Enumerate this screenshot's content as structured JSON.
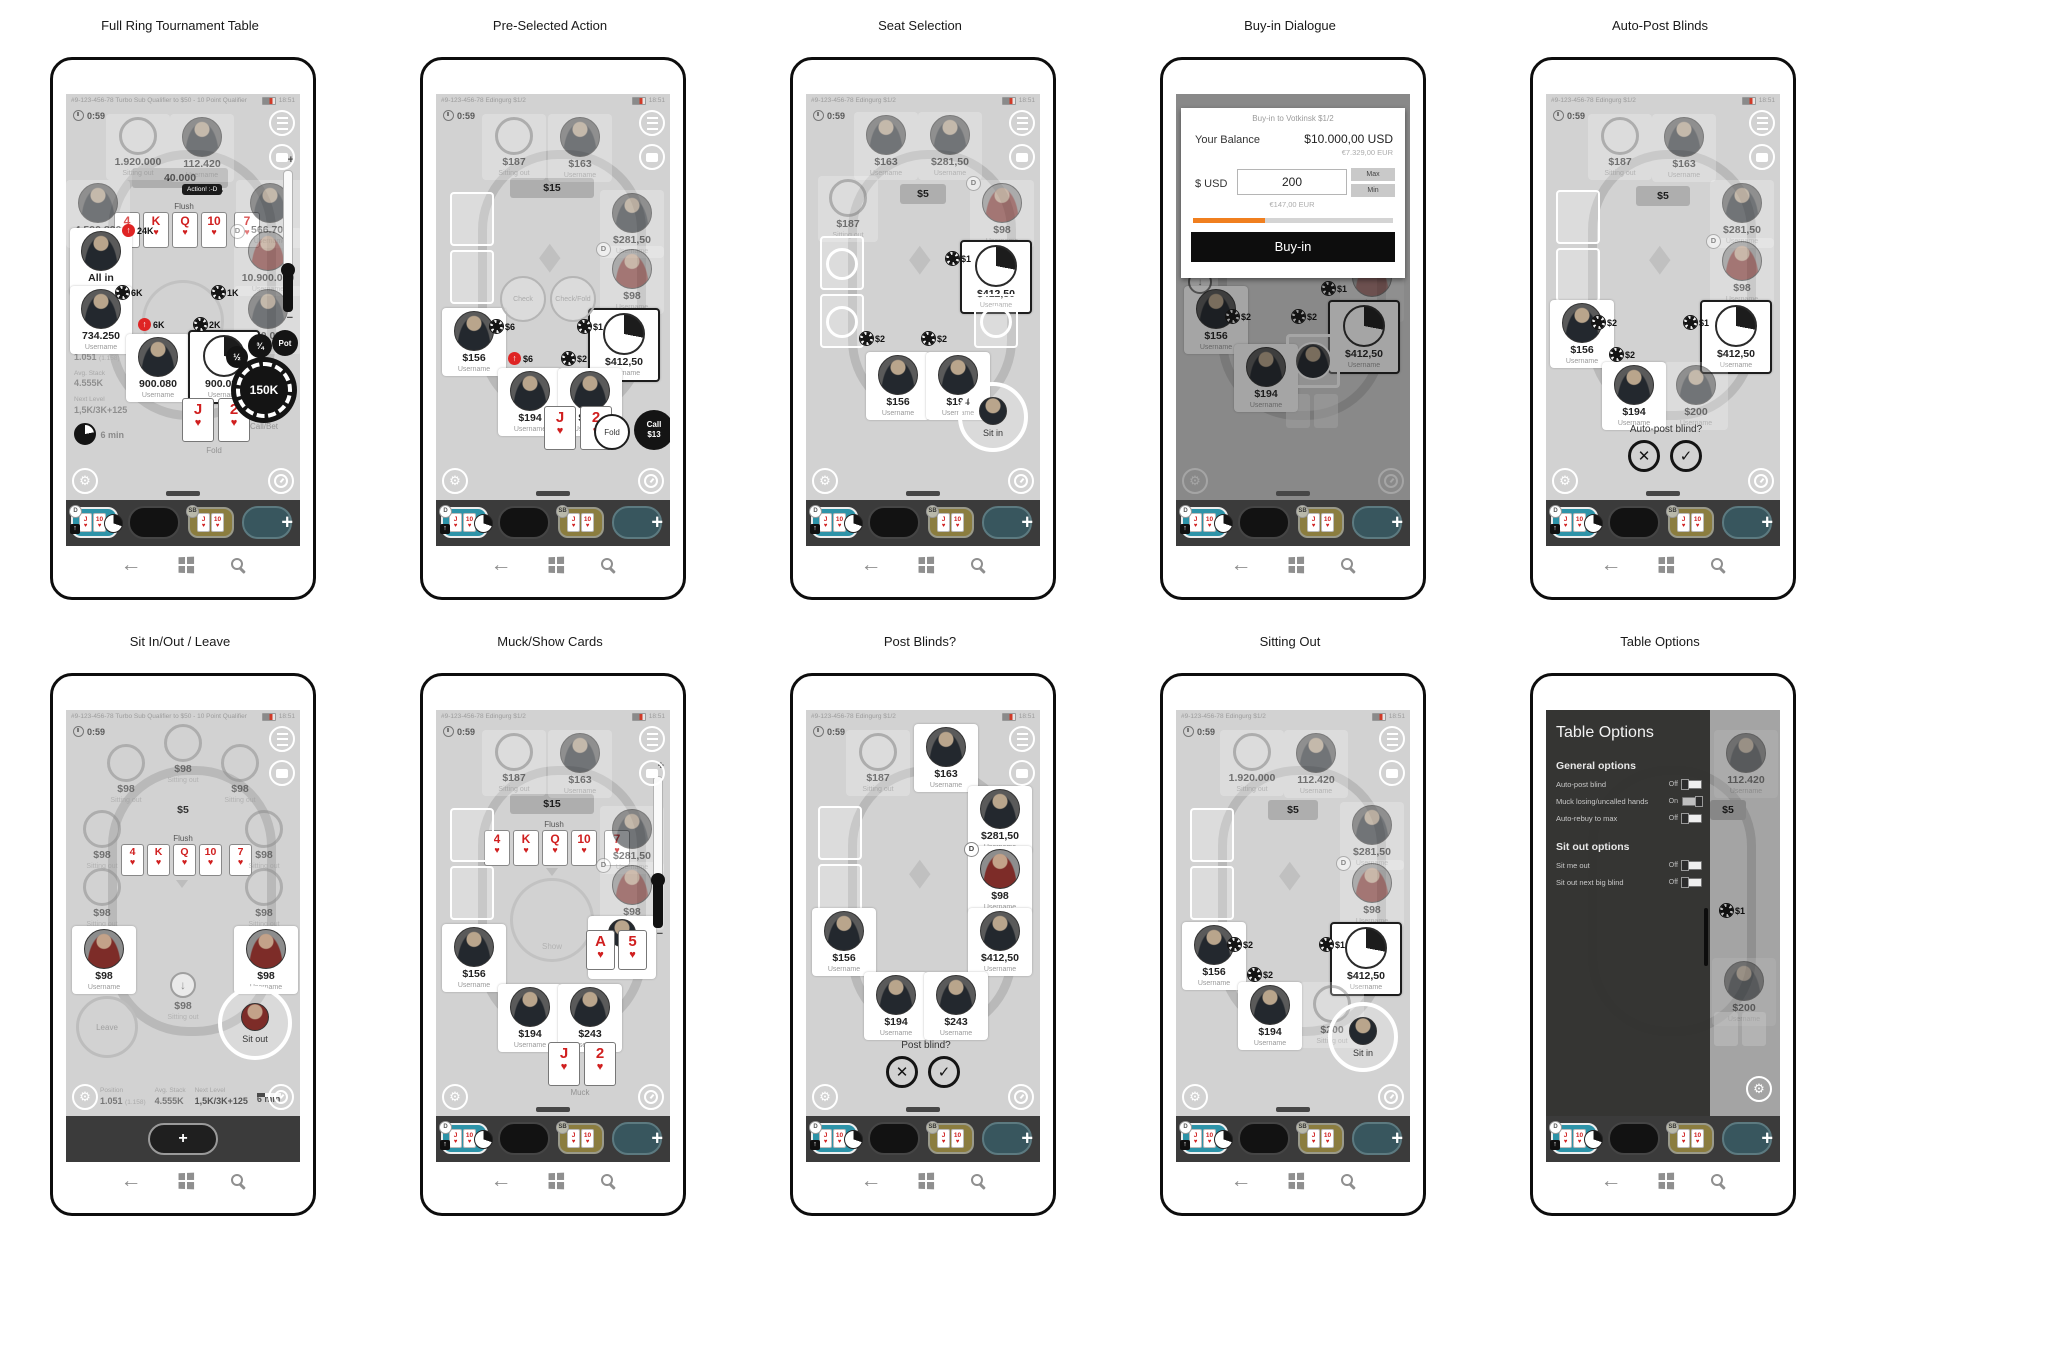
{
  "icons": {
    "up_arrow": "↑",
    "down_arrow": "↓",
    "close": "✕",
    "confirm": "✓",
    "plus": "+",
    "minus": "−",
    "back": "←",
    "heart": "♥",
    "diamond": "◆",
    "gear": "⚙",
    "half": "½",
    "three_quarters": "¾"
  },
  "shared": {
    "status_tourney": "#9-123-456-78  Turbo Sub Qualifier to $50 - 10 Point Qualifier",
    "status_cash": "#9-123-456-78  Edingurg $1/2",
    "clock": "18:51",
    "hand_timer": "0:59",
    "username": "Username",
    "sitting_out": "Sitting out",
    "flush": "Flush",
    "board": [
      "4",
      "K",
      "Q",
      "10",
      "7"
    ],
    "hero_cards": [
      "J",
      "2"
    ],
    "mini_cards": [
      "J",
      "10"
    ],
    "dealer_badge": "D",
    "sb_badge": "SB",
    "check": "Check",
    "check_fold": "Check/Fold",
    "fold": "Fold",
    "show": "Show",
    "muck": "Muck",
    "sit_in": "Sit in",
    "sit_out": "Sit out",
    "leave": "Leave",
    "pot_label": "Pot",
    "info": {
      "position_label": "Position",
      "position": "1.051",
      "position_alt": "(1.158)",
      "avg_label": "Avg. Stack",
      "avg": "4.555K",
      "next_label": "Next Level",
      "next": "1,5K/3K+125",
      "mins": "6 min"
    }
  },
  "phones": [
    {
      "title": "Full Ring Tournament Table",
      "pot": "40.000",
      "chat_bubble": "Action! :-D",
      "seats": {
        "tl": "1.920.000",
        "tr": "112.420",
        "l1": "4.590.800",
        "r1": "566.700",
        "l2": "All in",
        "r2": "10.900.080",
        "l3": "734.250",
        "r3": "900.080",
        "b1": "900.080",
        "hero": "900.080"
      },
      "bets": {
        "raise_a": "24K",
        "left": "6K",
        "right": "1K",
        "raise_b": "6K",
        "mid": "2K"
      },
      "actions": {
        "main": "150K",
        "main_label": "Call/Bet"
      }
    },
    {
      "title": "Pre-Selected Action",
      "pot": "$15",
      "seats": {
        "tl": "$187",
        "tr": "$163",
        "r1": "$281,50",
        "r2": "$98",
        "active": "$412,50",
        "l1": "$156",
        "b1": "$194",
        "b2": "$243"
      },
      "bets": {
        "left": "$6",
        "right": "$1",
        "raise": "$6",
        "mid": "$2"
      },
      "actions": {
        "call": "Call",
        "call_amount": "$13"
      }
    },
    {
      "title": "Seat Selection",
      "pot": "$5",
      "seats": {
        "t1": "$163",
        "t2": "$281,50",
        "l_sit": "$187",
        "r1": "$98",
        "active": "$412,50",
        "b1": "$156",
        "b2": "$194"
      },
      "bets": {
        "b1": "$2",
        "b2": "$2",
        "b3": "$1"
      }
    },
    {
      "title": "Buy-in Dialogue",
      "dialog": {
        "title": "Buy-in to Votkinsk $1/2",
        "balance_label": "Your Balance",
        "balance_usd": "$10.000,00 USD",
        "balance_eur": "€7.329,00 EUR",
        "currency": "$ USD",
        "amount": "200",
        "max": "Max",
        "min": "Min",
        "amount_eur": "€147,00 EUR",
        "submit": "Buy-in"
      },
      "seats": {
        "r1": "$98",
        "active": "$412,50",
        "l1": "$156",
        "b1": "$194"
      },
      "bets": {
        "b1": "$2",
        "b2": "$2",
        "b3": "$1"
      }
    },
    {
      "title": "Auto-Post Blinds",
      "pot": "$5",
      "prompt": "Auto-post blind?",
      "seats": {
        "tl": "$187",
        "tr": "$163",
        "r1": "$281,50",
        "r2": "$98",
        "active": "$412,50",
        "l1": "$156",
        "b1": "$194",
        "b2": "$200"
      },
      "bets": {
        "b1": "$2",
        "b2": "$2",
        "b3": "$1"
      }
    },
    {
      "title": "Sit In/Out / Leave",
      "pot": "$5",
      "sit_stack": "$98",
      "player_stack": "$98"
    },
    {
      "title": "Muck/Show Cards",
      "pot": "$15",
      "shown_cards": [
        "A",
        "5"
      ],
      "seats": {
        "tl": "$187",
        "tr": "$163",
        "r1": "$281,50",
        "r2": "$98",
        "l1": "$156",
        "b1": "$194",
        "b2": "$243"
      }
    },
    {
      "title": "Post Blinds?",
      "prompt": "Post blind?",
      "seats": {
        "tl": "$187",
        "tr": "$163",
        "r1": "$281,50",
        "r2": "$98",
        "r3": "$412,50",
        "l1": "$156",
        "b1": "$194",
        "b2": "$243"
      }
    },
    {
      "title": "Sitting Out",
      "pot": "$5",
      "seats": {
        "tl": "1.920.000",
        "tr": "112.420",
        "r1": "$281,50",
        "r2": "$98",
        "active": "$412,50",
        "l1": "$156",
        "b1": "$194",
        "bc": "$200"
      },
      "bets": {
        "b1": "$2",
        "b2": "$2",
        "b3": "$1"
      }
    },
    {
      "title": "Table Options",
      "panel": {
        "title": "Table Options",
        "general_header": "General options",
        "general": [
          {
            "label": "Auto-post blind",
            "state": "Off"
          },
          {
            "label": "Muck losing/uncalled hands",
            "state": "On"
          },
          {
            "label": "Auto-rebuy to max",
            "state": "Off"
          }
        ],
        "sitout_header": "Sit out options",
        "sitout": [
          {
            "label": "Sit me out",
            "state": "Off"
          },
          {
            "label": "Sit out next big blind",
            "state": "Off"
          }
        ]
      },
      "bg": {
        "tr": "112.420",
        "pot": "$5",
        "bet": "$1",
        "b2": "$200"
      }
    }
  ]
}
